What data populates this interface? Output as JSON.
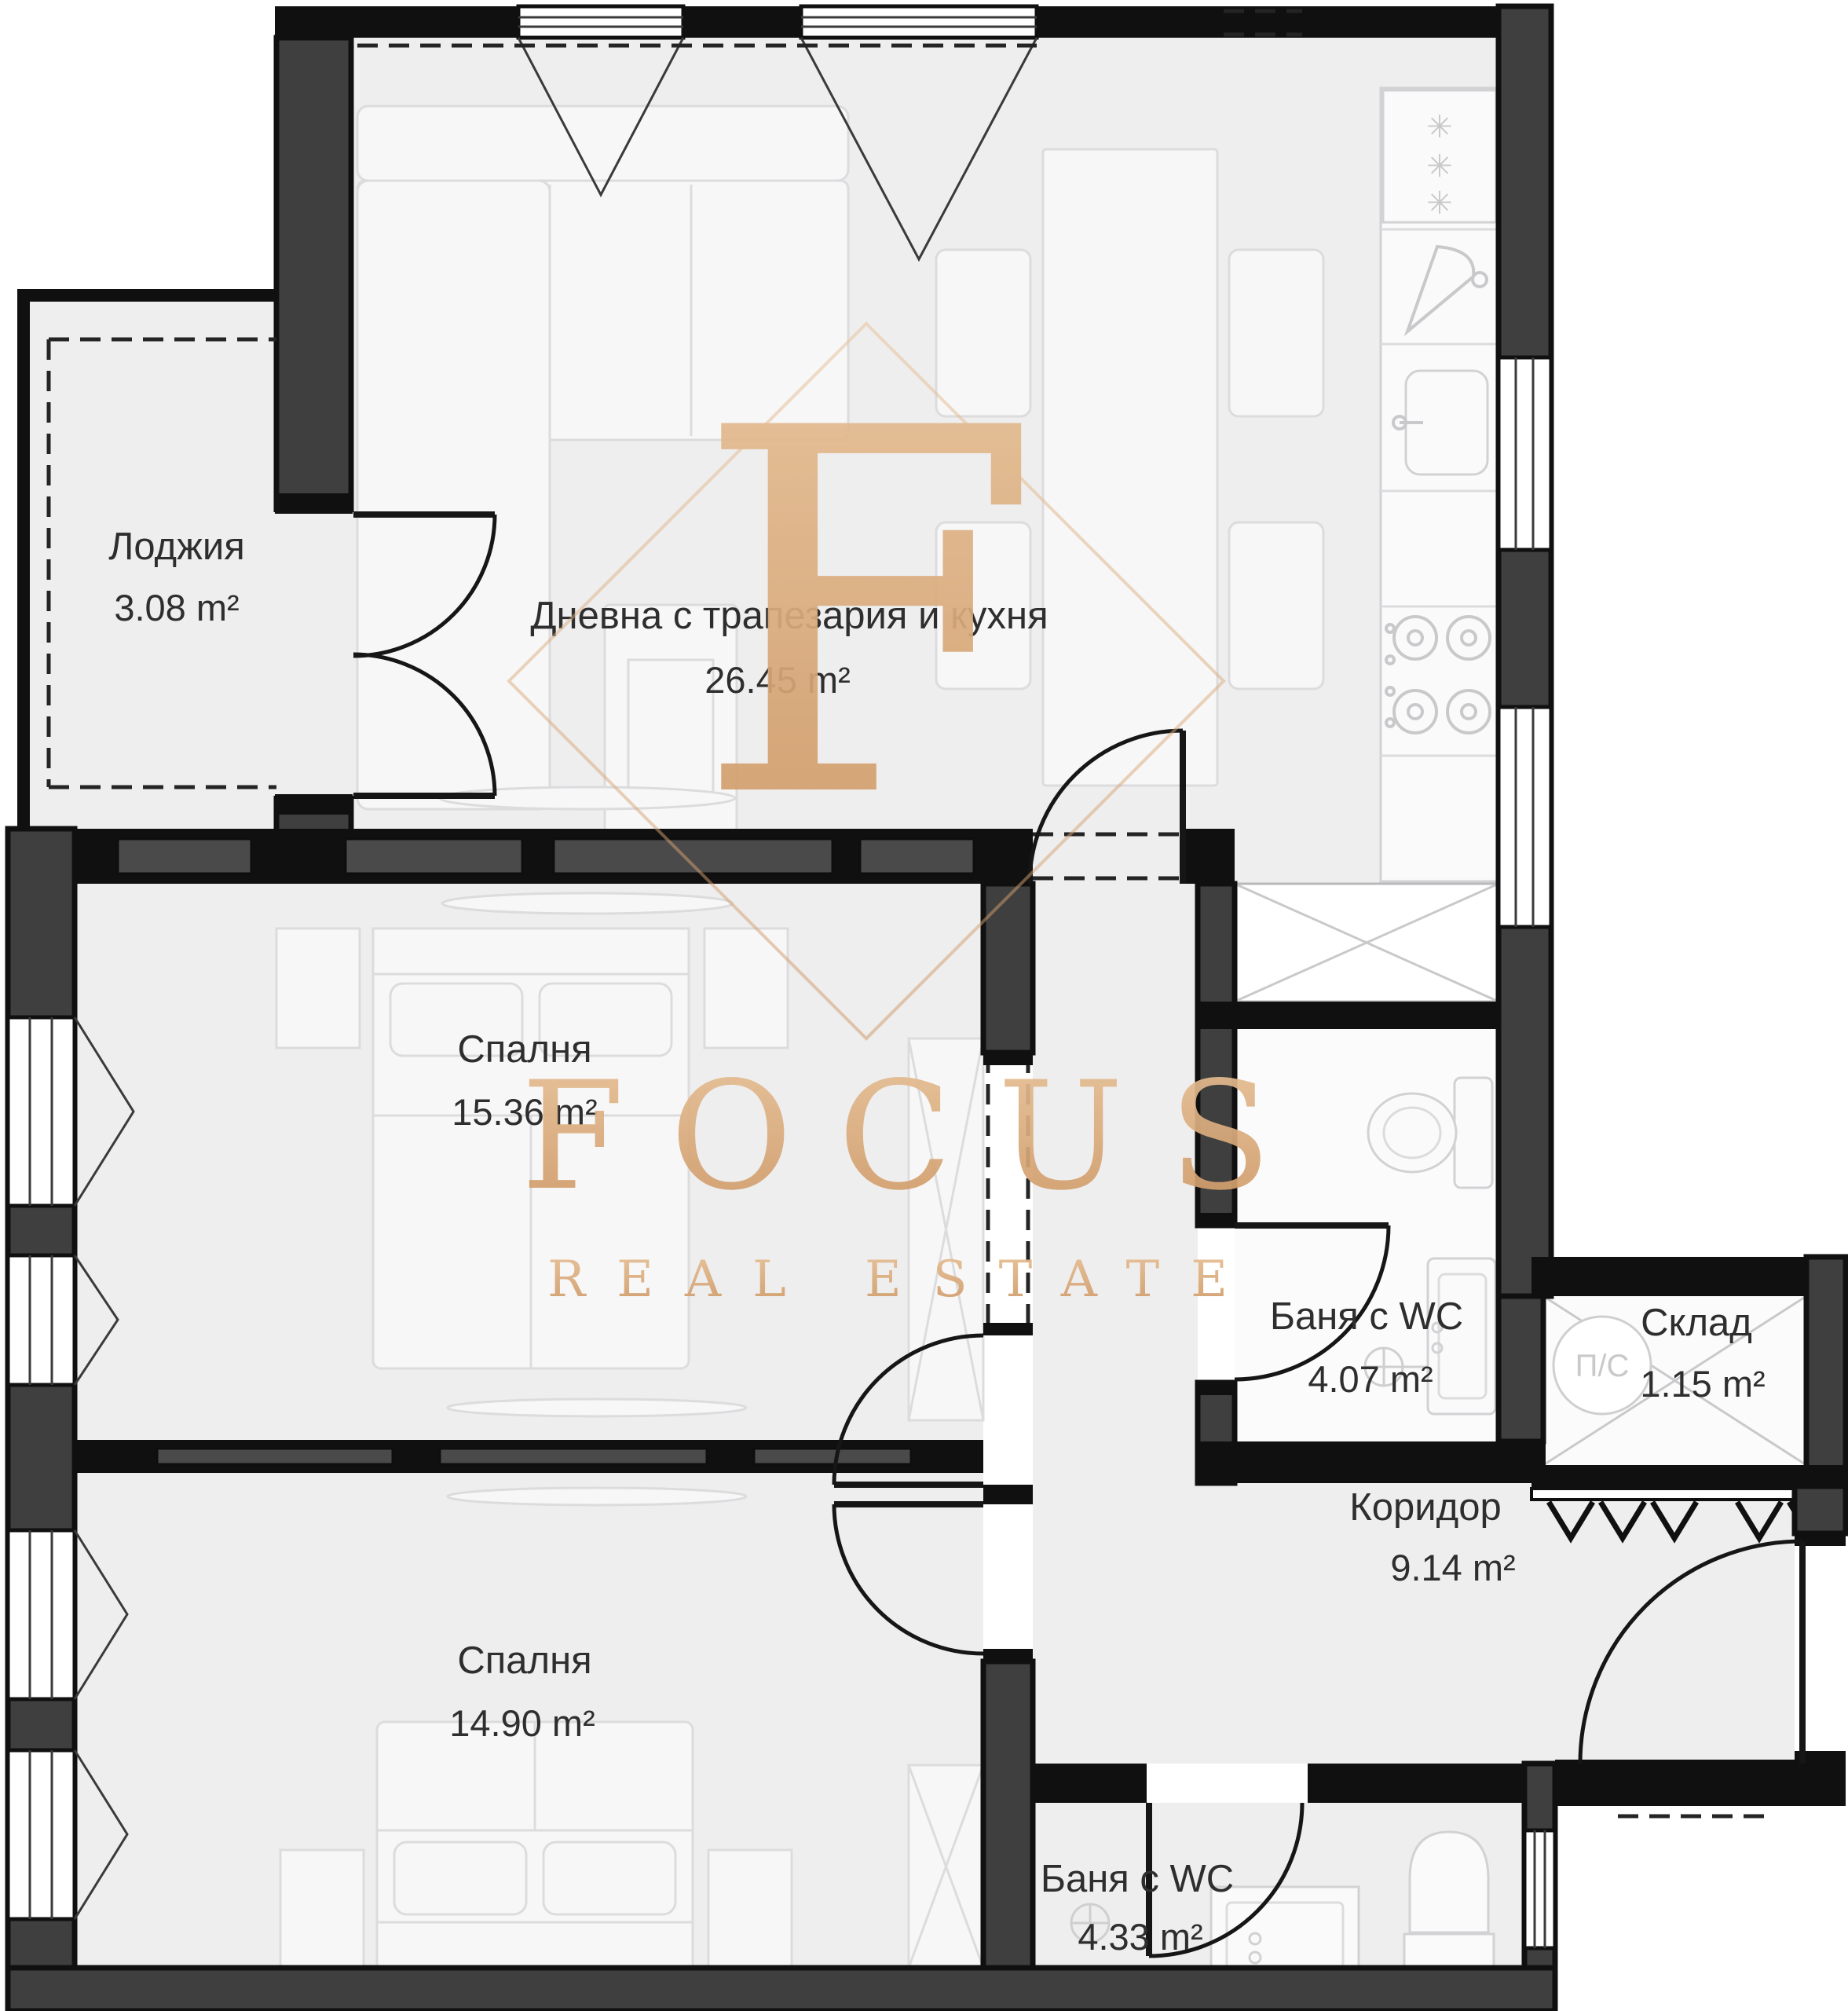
{
  "plan": {
    "rooms": [
      {
        "name": "Лоджия",
        "area": "3.08 m²"
      },
      {
        "name": "Дневна с трапезария и кухня",
        "area": "26.45 m²"
      },
      {
        "name": "Спалня",
        "area": "15.36 m²"
      },
      {
        "name": "Баня с WC",
        "area": "4.07 m²"
      },
      {
        "name": "Склад",
        "area": "1.15 m²"
      },
      {
        "name": "Коридор",
        "area": "9.14 m²"
      },
      {
        "name": "Спалня",
        "area": "14.90 m²"
      },
      {
        "name": "Баня с WC",
        "area": "4.33 m²"
      }
    ],
    "storage_symbol": "П/С",
    "watermark": {
      "letter": "F",
      "title": "FOCUS",
      "subtitle": "REAL ESTATE",
      "gold_light": "#e7c096",
      "gold_dark": "#cd9763"
    },
    "colors": {
      "wall_fill": "#3f3f3f",
      "wall_outline": "#101010",
      "floor": "#eeeeef",
      "watermark_gold": "#d9a873"
    }
  }
}
